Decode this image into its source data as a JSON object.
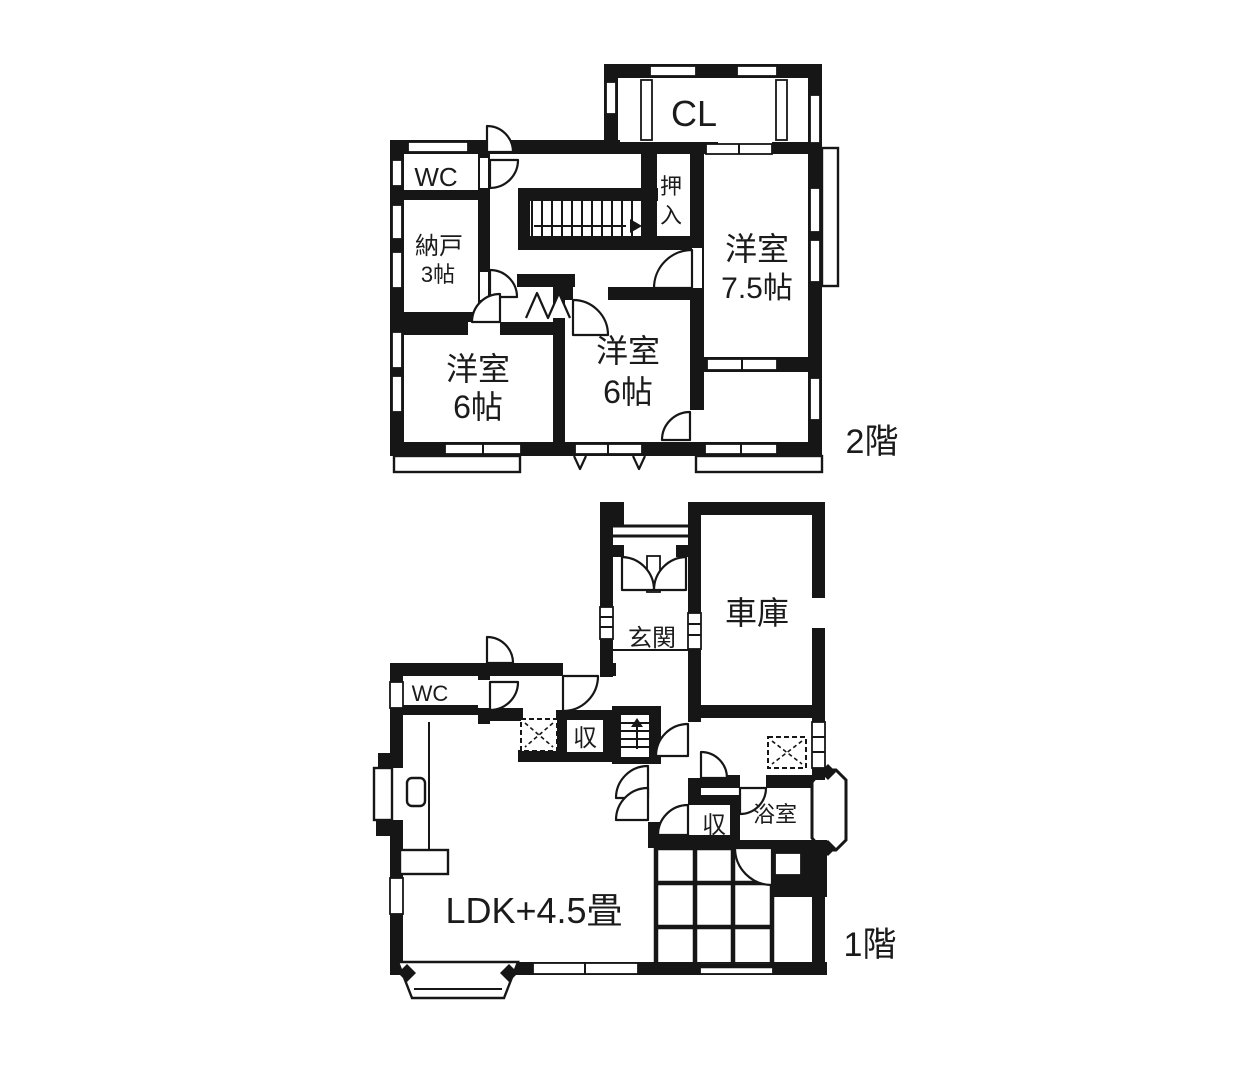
{
  "colors": {
    "wall": "#161616",
    "background": "#ffffff",
    "text": "#1b1b1b"
  },
  "floor2": {
    "floor_label": "2階",
    "closet": "CL",
    "wc": "WC",
    "storeroom_line1": "納戸",
    "storeroom_line2": "3帖",
    "oshiire_char1": "押",
    "oshiire_char2": "入",
    "western_room_75_line1": "洋室",
    "western_room_75_line2": "7.5帖",
    "western_room_6_left_line1": "洋室",
    "western_room_6_left_line2": "6帖",
    "western_room_6_mid_line1": "洋室",
    "western_room_6_mid_line2": "6帖"
  },
  "floor1": {
    "floor_label": "1階",
    "entrance": "玄関",
    "garage": "車庫",
    "wc": "WC",
    "storage_kitchen": "収",
    "storage_hall": "収",
    "bathroom": "浴室",
    "ldk": "LDK+4.5畳"
  }
}
